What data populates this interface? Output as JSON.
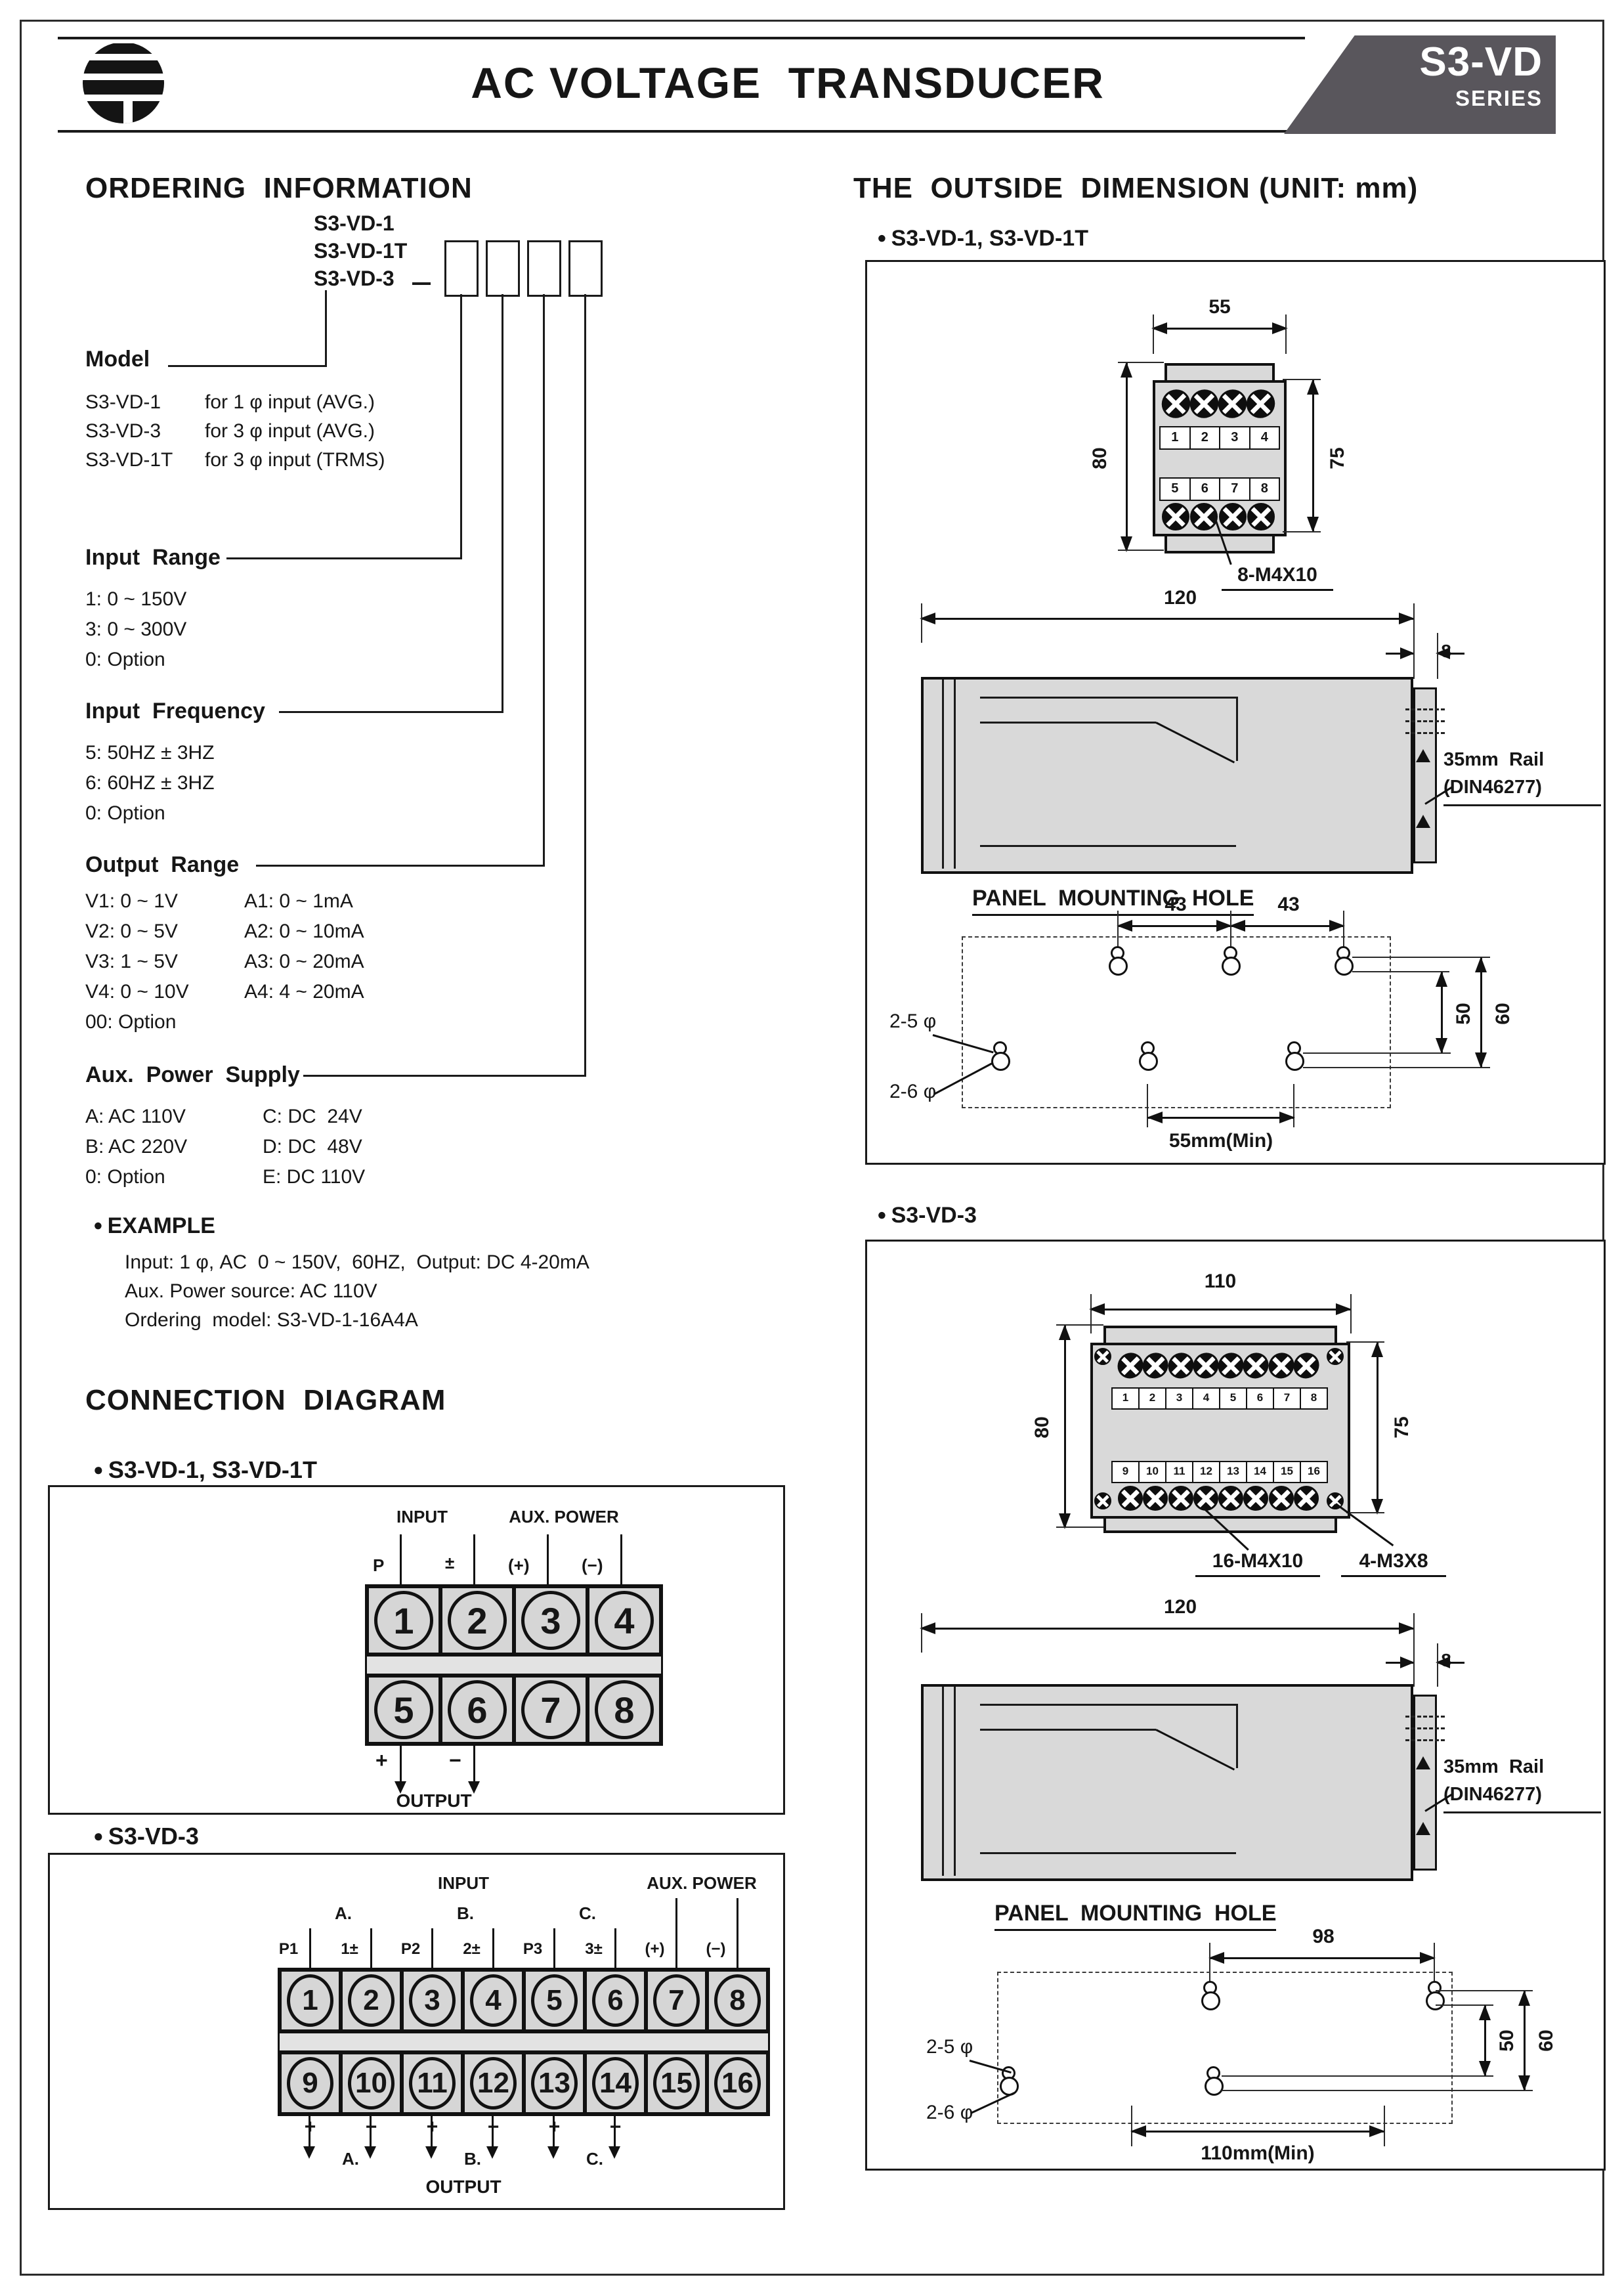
{
  "header": {
    "title": "AC VOLTAGE  TRANSDUCER",
    "badge_model": "S3-VD",
    "badge_series": "SERIES"
  },
  "ordering": {
    "heading": "ORDERING  INFORMATION",
    "models": [
      "S3-VD-1",
      "S3-VD-1T",
      "S3-VD-3"
    ],
    "model_section": {
      "label": "Model",
      "rows": [
        {
          "code": "S3-VD-1",
          "desc": "for 1 φ input (AVG.)"
        },
        {
          "code": "S3-VD-3",
          "desc": "for 3 φ input (AVG.)"
        },
        {
          "code": "S3-VD-1T",
          "desc": "for 3 φ input (TRMS)"
        }
      ]
    },
    "input_range": {
      "label": "Input  Range",
      "items": [
        "1: 0 ~ 150V",
        "3: 0 ~ 300V",
        "0: Option"
      ]
    },
    "input_frequency": {
      "label": "Input  Frequency",
      "items": [
        "5: 50HZ ± 3HZ",
        "6: 60HZ ± 3HZ",
        "0: Option"
      ]
    },
    "output_range": {
      "label": "Output  Range",
      "col1": [
        "V1: 0 ~ 1V",
        "V2: 0 ~ 5V",
        "V3: 1 ~ 5V",
        "V4: 0 ~ 10V",
        "00: Option"
      ],
      "col2": [
        "A1: 0 ~ 1mA",
        "A2: 0 ~ 10mA",
        "A3: 0 ~ 20mA",
        "A4: 4 ~ 20mA"
      ]
    },
    "aux_power": {
      "label": "Aux.  Power  Supply",
      "col1": [
        "A: AC 110V",
        "B: AC 220V",
        "0: Option"
      ],
      "col2": [
        "C: DC  24V",
        "D: DC  48V",
        "E: DC 110V"
      ]
    },
    "example": {
      "label": "EXAMPLE",
      "lines": [
        "Input: 1 φ, AC  0 ~ 150V,  60HZ,  Output: DC 4-20mA",
        "Aux. Power source: AC 110V",
        "Ordering  model: S3-VD-1-16A4A"
      ]
    }
  },
  "connection": {
    "heading": "CONNECTION  DIAGRAM",
    "d1": {
      "bullet": "S3-VD-1, S3-VD-1T",
      "input_label": "INPUT",
      "aux_label": "AUX. POWER",
      "pin_labels": [
        "P",
        "±",
        "(+)",
        "(−)"
      ],
      "row1": [
        "1",
        "2",
        "3",
        "4"
      ],
      "row2": [
        "5",
        "6",
        "7",
        "8"
      ],
      "out_plus": "+",
      "out_minus": "−",
      "output_label": "OUTPUT"
    },
    "d2": {
      "bullet": "S3-VD-3",
      "input_label": "INPUT",
      "aux_label": "AUX. POWER",
      "phase_top": [
        "A.",
        "B.",
        "C."
      ],
      "pin_labels": [
        "P1",
        "1±",
        "P2",
        "2±",
        "P3",
        "3±",
        "(+)",
        "(−)"
      ],
      "row1": [
        "1",
        "2",
        "3",
        "4",
        "5",
        "6",
        "7",
        "8"
      ],
      "row2": [
        "9",
        "10",
        "11",
        "12",
        "13",
        "14",
        "15",
        "16"
      ],
      "signs": [
        "+",
        "−",
        "+",
        "−",
        "+",
        "−"
      ],
      "phase_bottom": [
        "A.",
        "B.",
        "C."
      ],
      "output_label": "OUTPUT"
    }
  },
  "dimension": {
    "heading": "THE  OUTSIDE  DIMENSION (UNIT: mm)",
    "d1": {
      "bullet": "S3-VD-1, S3-VD-1T",
      "front": {
        "width": "55",
        "height_left": "80",
        "height_right": "75",
        "row1": [
          "1",
          "2",
          "3",
          "4"
        ],
        "row2": [
          "5",
          "6",
          "7",
          "8"
        ],
        "screw_label": "8-M4X10"
      },
      "side": {
        "width": "120",
        "rail_w": "8",
        "rail_label1": "35mm  Rail",
        "rail_label2": "(DIN46277)"
      },
      "panel": {
        "heading": "PANEL  MOUNTING  HOLE",
        "dim_a": "43",
        "dim_b": "43",
        "dim_r_inner": "50",
        "dim_r_outer": "60",
        "hole_top": "2-5 φ",
        "hole_bottom": "2-6 φ",
        "min_label": "55mm(Min)"
      }
    },
    "d2": {
      "bullet": "S3-VD-3",
      "front": {
        "width": "110",
        "height_left": "80",
        "height_right": "75",
        "row1": [
          "1",
          "2",
          "3",
          "4",
          "5",
          "6",
          "7",
          "8"
        ],
        "row2": [
          "9",
          "10",
          "11",
          "12",
          "13",
          "14",
          "15",
          "16"
        ],
        "screw_label": "16-M4X10",
        "corner_label": "4-M3X8"
      },
      "side": {
        "width": "120",
        "rail_w": "8",
        "rail_label1": "35mm  Rail",
        "rail_label2": "(DIN46277)"
      },
      "panel": {
        "heading": "PANEL  MOUNTING  HOLE",
        "dim_a": "98",
        "dim_r_inner": "50",
        "dim_r_outer": "60",
        "hole_top": "2-5 φ",
        "hole_bottom": "2-6 φ",
        "min_label": "110mm(Min)"
      }
    }
  }
}
